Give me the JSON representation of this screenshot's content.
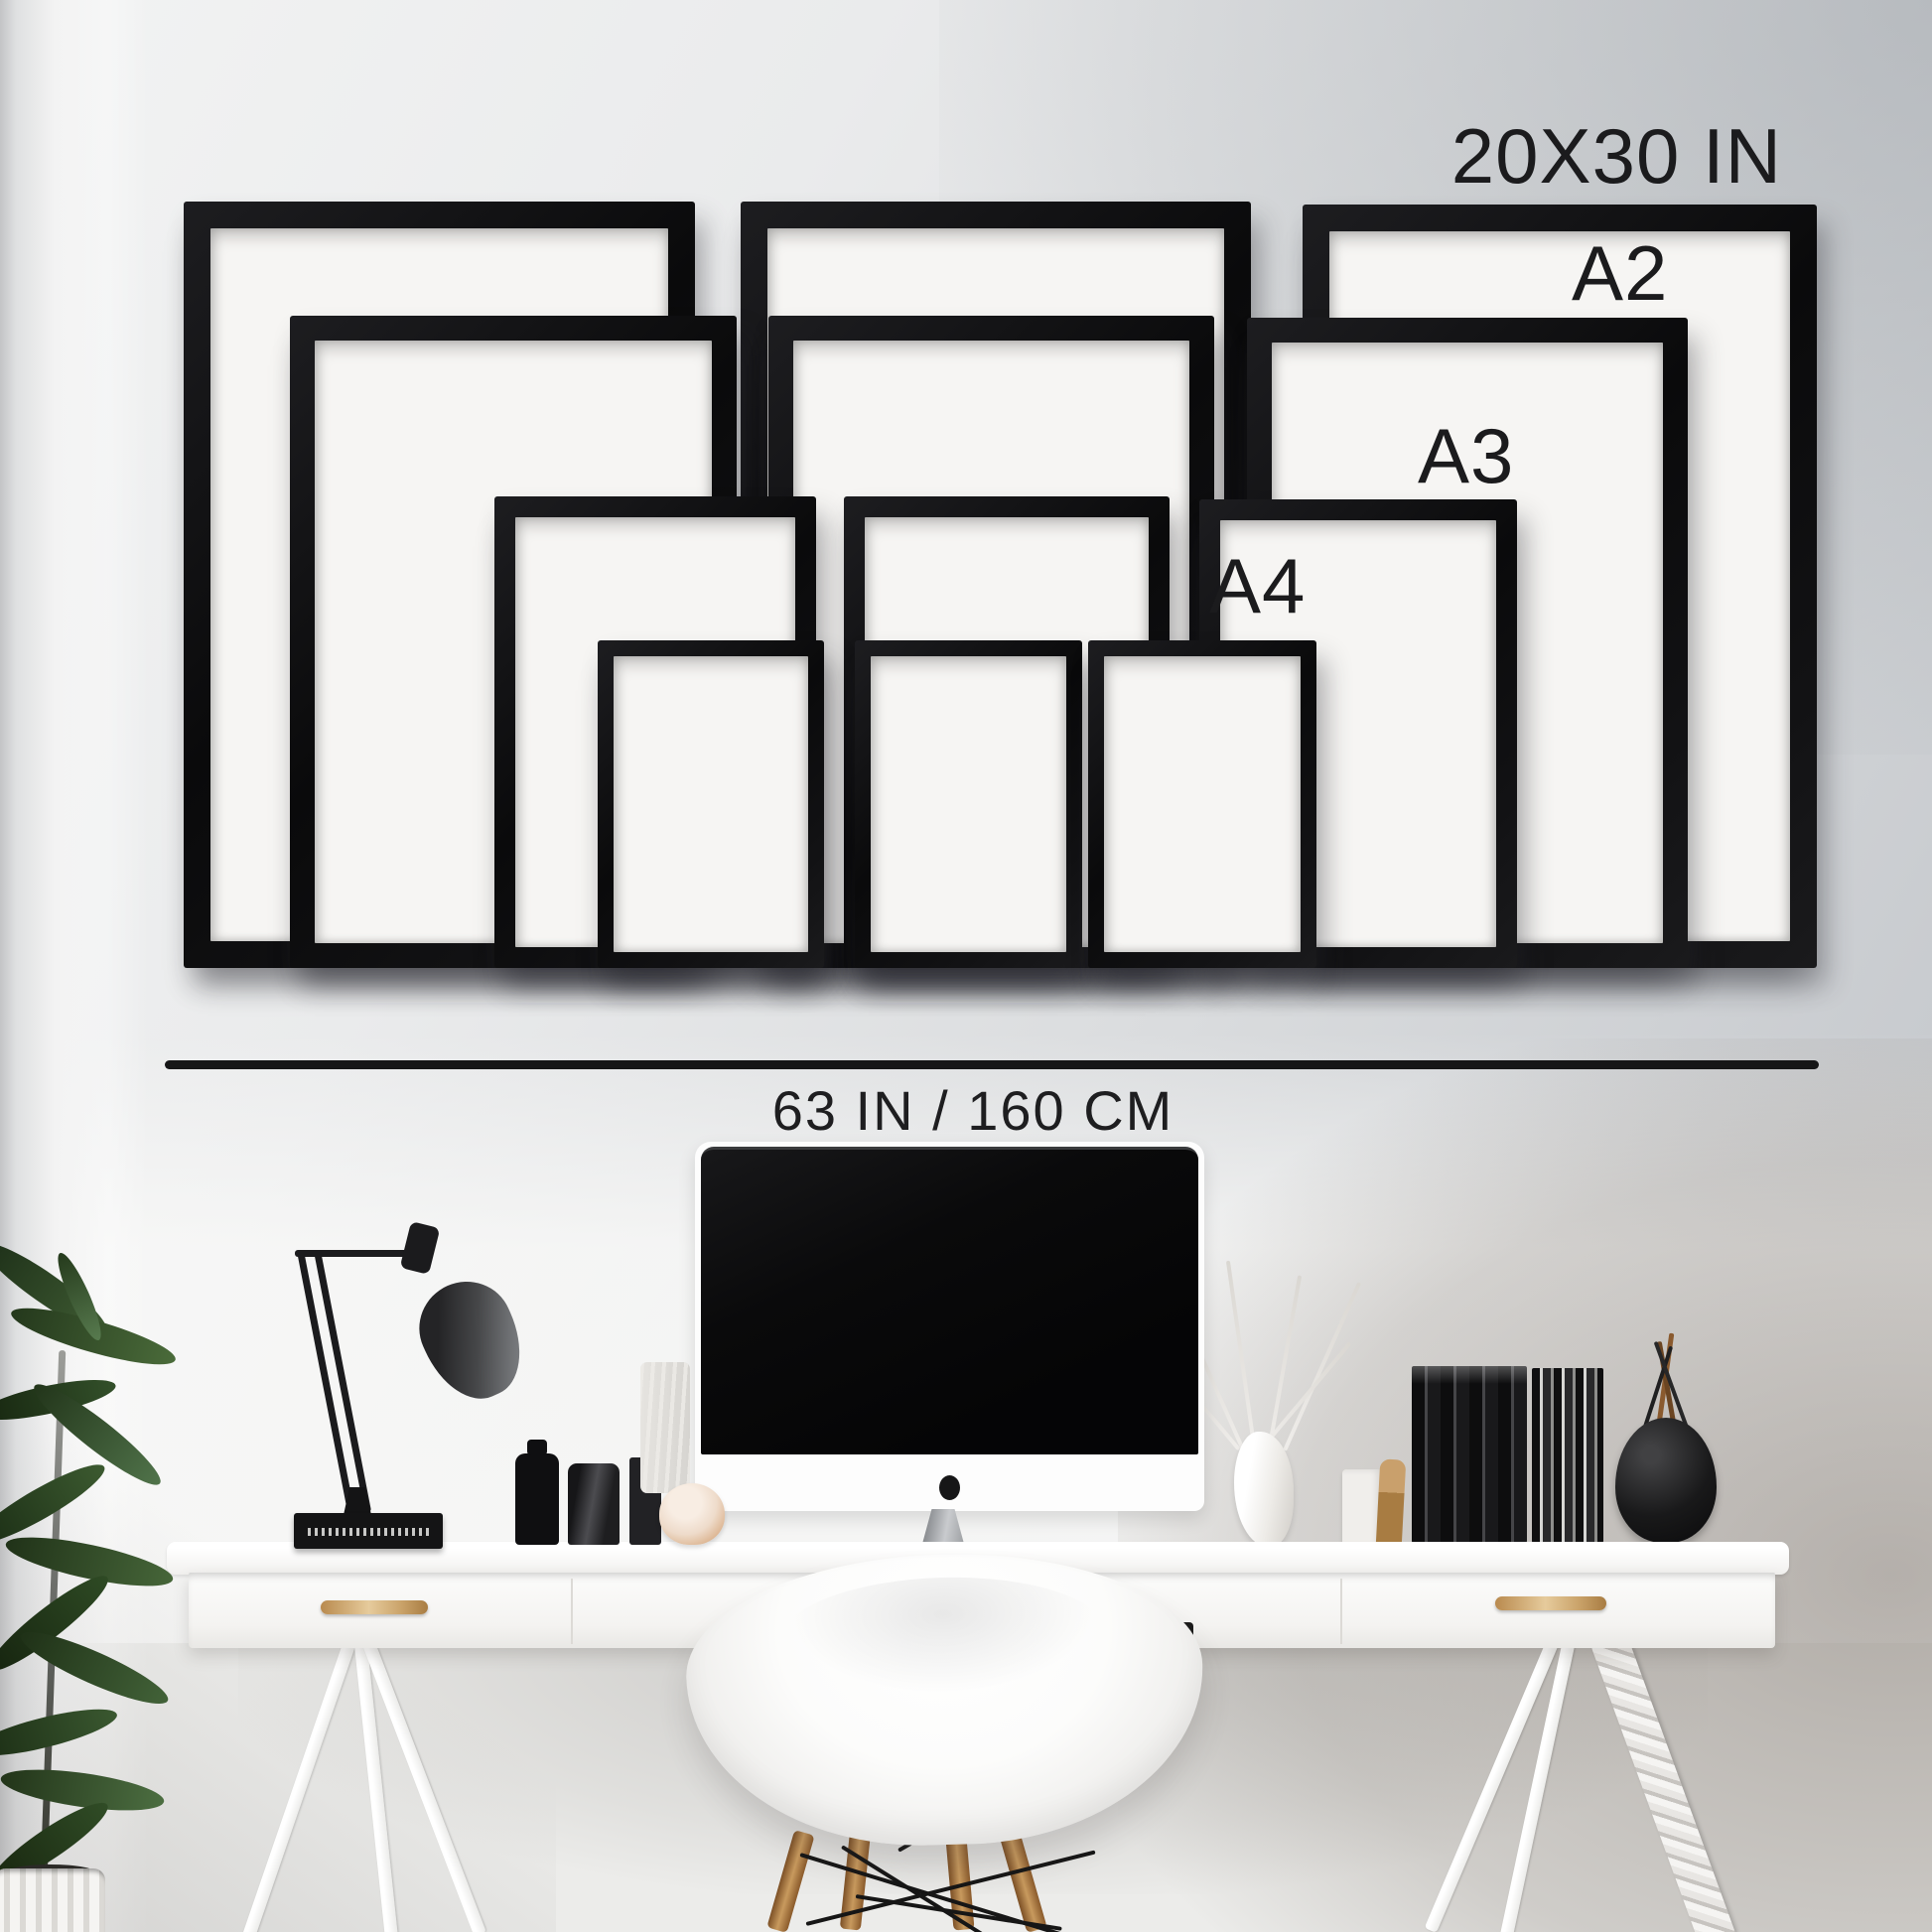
{
  "labels": {
    "largest_size": "20X30 IN",
    "a2": "A2",
    "a3": "A3",
    "a4": "A4",
    "measurement": "63 IN / 160 CM"
  },
  "frames": {
    "rows": [
      {
        "size": "20X30 IN",
        "count": 3
      },
      {
        "size": "A2",
        "count": 3
      },
      {
        "size": "A3",
        "count": 3
      },
      {
        "size": "A4",
        "count": 3
      }
    ],
    "frame_color": "#0d0d0e",
    "paper_color": "#f6f5f3"
  },
  "colors": {
    "wall_gray": "#c2c5c9",
    "wall_light": "#f2f2f2",
    "text": "#1b1b1d",
    "line": "#161617",
    "desk_white": "#fbfbfa",
    "wood_accent": "#b9854c",
    "plant_green": "#33502a"
  },
  "scene_objects": [
    "potted-plant",
    "desk-lamp",
    "black-book",
    "black-bottles",
    "birch-vase",
    "marble-box",
    "imac-computer",
    "white-vase-with-branches",
    "white-block",
    "wood-brush",
    "black-records",
    "round-black-vase-with-sticks",
    "white-desk",
    "drawer-handles",
    "eames-armchair",
    "trestle-legs",
    "rope-wrapped-leg"
  ]
}
